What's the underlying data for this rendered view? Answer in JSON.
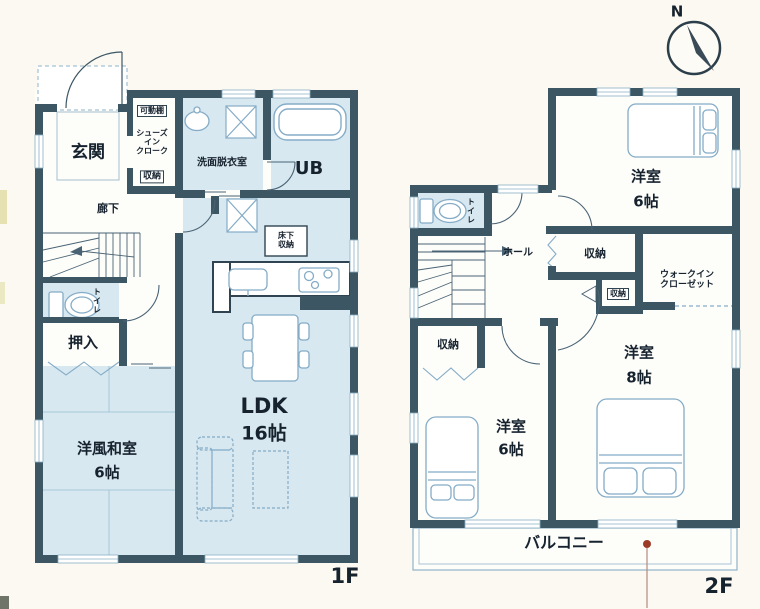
{
  "page": {
    "floor1_label": "1F",
    "floor2_label": "2F",
    "compass_north": "N"
  },
  "colors": {
    "wall": "#3c5664",
    "room_blue": "#d7e8f0",
    "line_blue": "#85acc7",
    "outline_dark": "#2f4450",
    "text": "#16222e",
    "marker_red": "#9c3b28",
    "paper": "#fbf9f1"
  },
  "floor1": {
    "entrance": "玄関",
    "shoes_closet_lines": [
      "シューズ",
      "イン",
      "クローク"
    ],
    "movable_shelf": "可動棚",
    "shoes_storage": "収納",
    "hallway": "廊下",
    "washroom": "洗面脱衣室",
    "unit_bath": "UB",
    "underfloor_storage_lines": [
      "床下",
      "収納"
    ],
    "toilet": "トイレ",
    "closet": "押入",
    "japanese_room": "洋風和室",
    "japanese_room_size": "6帖",
    "ldk": "LDK",
    "ldk_size": "16帖"
  },
  "floor2": {
    "toilet": "トイレ",
    "hall": "ホール",
    "storage_upper": "収納",
    "storage_middle": "収納",
    "storage_lower": "収納",
    "walkin_closet_lines": [
      "ウォークイン",
      "クローゼット"
    ],
    "bedroom_ne": "洋室",
    "bedroom_ne_size": "6帖",
    "bedroom_sw": "洋室",
    "bedroom_sw_size": "6帖",
    "bedroom_se": "洋室",
    "bedroom_se_size": "8帖",
    "balcony": "バルコニー"
  }
}
